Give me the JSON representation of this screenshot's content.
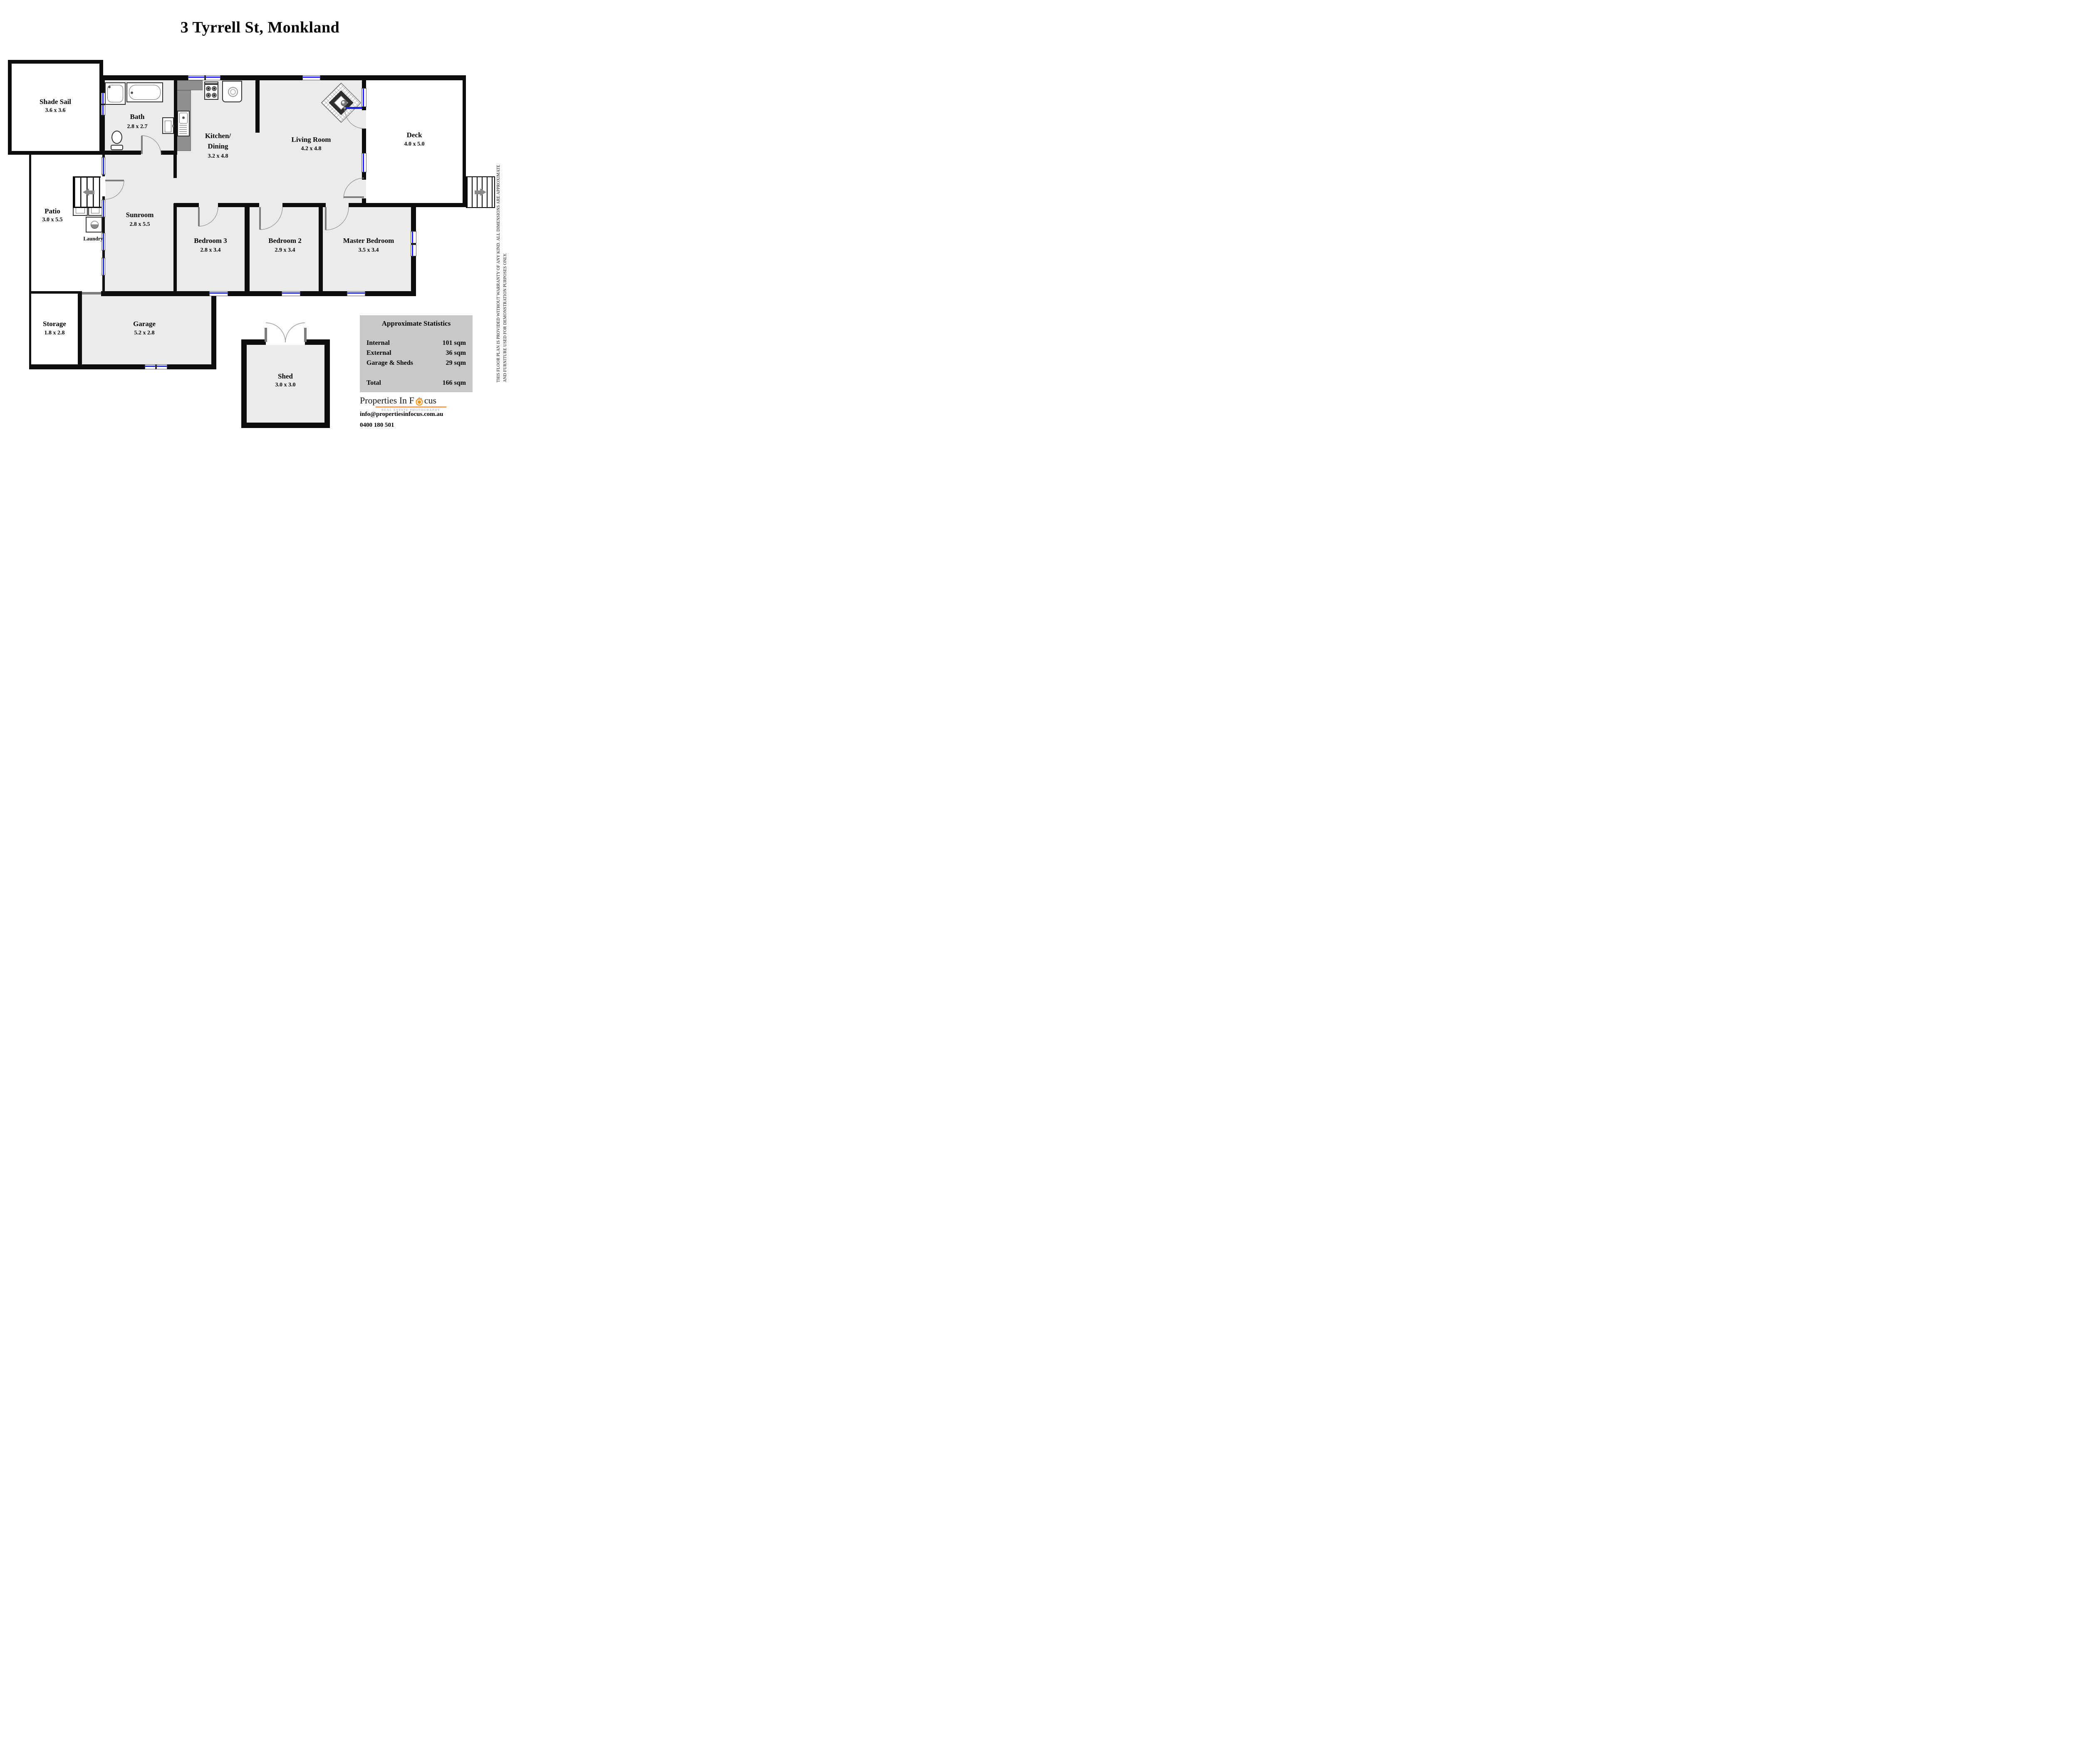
{
  "title": "3 Tyrrell St, Monkland",
  "rooms": {
    "shade_sail": {
      "name": "Shade Sail",
      "dims": "3.6 x 3.6"
    },
    "bath": {
      "name": "Bath",
      "dims": "2.8 x 2.7"
    },
    "kitchen": {
      "name_line1": "Kitchen/",
      "name_line2": "Dining",
      "dims": "3.2 x 4.8"
    },
    "living": {
      "name": "Living Room",
      "dims": "4.2 x 4.8"
    },
    "deck": {
      "name": "Deck",
      "dims": "4.0 x 5.0"
    },
    "patio": {
      "name": "Patio",
      "dims": "3.0 x 5.5"
    },
    "laundry": {
      "name": "Laundry"
    },
    "sunroom": {
      "name": "Sunroom",
      "dims": "2.8 x 5.5"
    },
    "bedroom3": {
      "name": "Bedroom 3",
      "dims": "2.8 x 3.4"
    },
    "bedroom2": {
      "name": "Bedroom 2",
      "dims": "2.9 x 3.4"
    },
    "master": {
      "name": "Master Bedroom",
      "dims": "3.5 x 3.4"
    },
    "storage": {
      "name": "Storage",
      "dims": "1.8 x 2.8"
    },
    "garage": {
      "name": "Garage",
      "dims": "5.2 x 2.8"
    },
    "shed": {
      "name": "Shed",
      "dims": "3.0 x 3.0"
    }
  },
  "stats": {
    "title": "Approximate Statistics",
    "rows": [
      {
        "label": "Internal",
        "value": "101 sqm"
      },
      {
        "label": "External",
        "value": "36 sqm"
      },
      {
        "label": "Garage & Sheds",
        "value": "29 sqm"
      }
    ],
    "total": {
      "label": "Total",
      "value": "166 sqm"
    }
  },
  "logo": {
    "name_pre": "Properties In F",
    "name_post": "cus",
    "tagline": "REAL ESTATE PHOTOGRAPHY",
    "accent_color": "#f49a2a",
    "icon": "camera-lens-house-icon"
  },
  "contact": {
    "email": "info@propertiesinfocus.com.au",
    "phone": "0400 180 501"
  },
  "disclaimer": {
    "line1": "THIS FLOOR PLAN IS PROVIDED WITHOUT WARRANTY OF ANY KIND. ALL DIMENSIONS ARE APPROXIMATE",
    "line2": "AND FURNITURE USED FOR DEMONSTRATION PURPOSES ONLY."
  },
  "colors": {
    "wall": "#0d0d0d",
    "floor": "#ebebeb",
    "window": "#2222ee",
    "counter": "#8f8f8f",
    "stats_panel": "#c8c8c8",
    "logo_accent": "#f49a2a"
  }
}
